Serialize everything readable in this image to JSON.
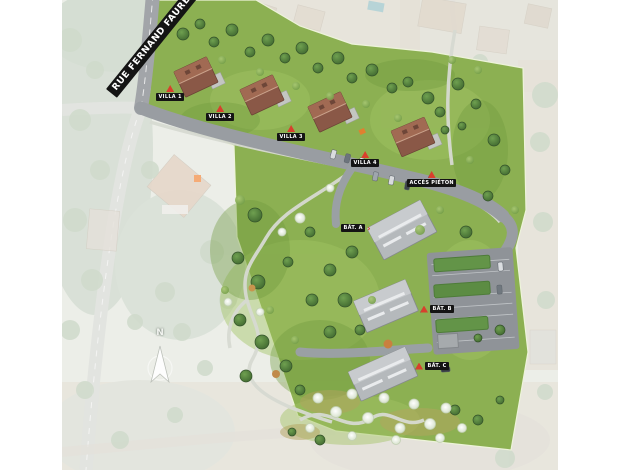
{
  "street": {
    "name": "RUE FERNAND FAURÉ"
  },
  "compass": {
    "north_label": "N"
  },
  "markers": [
    {
      "id": "villa-1",
      "label": "VILLA 1"
    },
    {
      "id": "villa-2",
      "label": "VILLA 2"
    },
    {
      "id": "villa-3",
      "label": "VILLA 3"
    },
    {
      "id": "villa-4",
      "label": "VILLA 4"
    },
    {
      "id": "acces-pieton",
      "label": "ACCÈS PIÉTON"
    },
    {
      "id": "bat-a",
      "label": "BÂT. A",
      "arrow": "›"
    },
    {
      "id": "bat-b",
      "label": "BÂT. B"
    },
    {
      "id": "bat-c",
      "label": "BÂT. C"
    }
  ],
  "colors": {
    "site_green": "#8cb052",
    "villa_roof_brown": "#8a5847",
    "collective_roof_gray": "#b5b9bc",
    "road_gray": "#9a9da2",
    "marker_red": "#d8402c",
    "banner_black": "#141414"
  }
}
